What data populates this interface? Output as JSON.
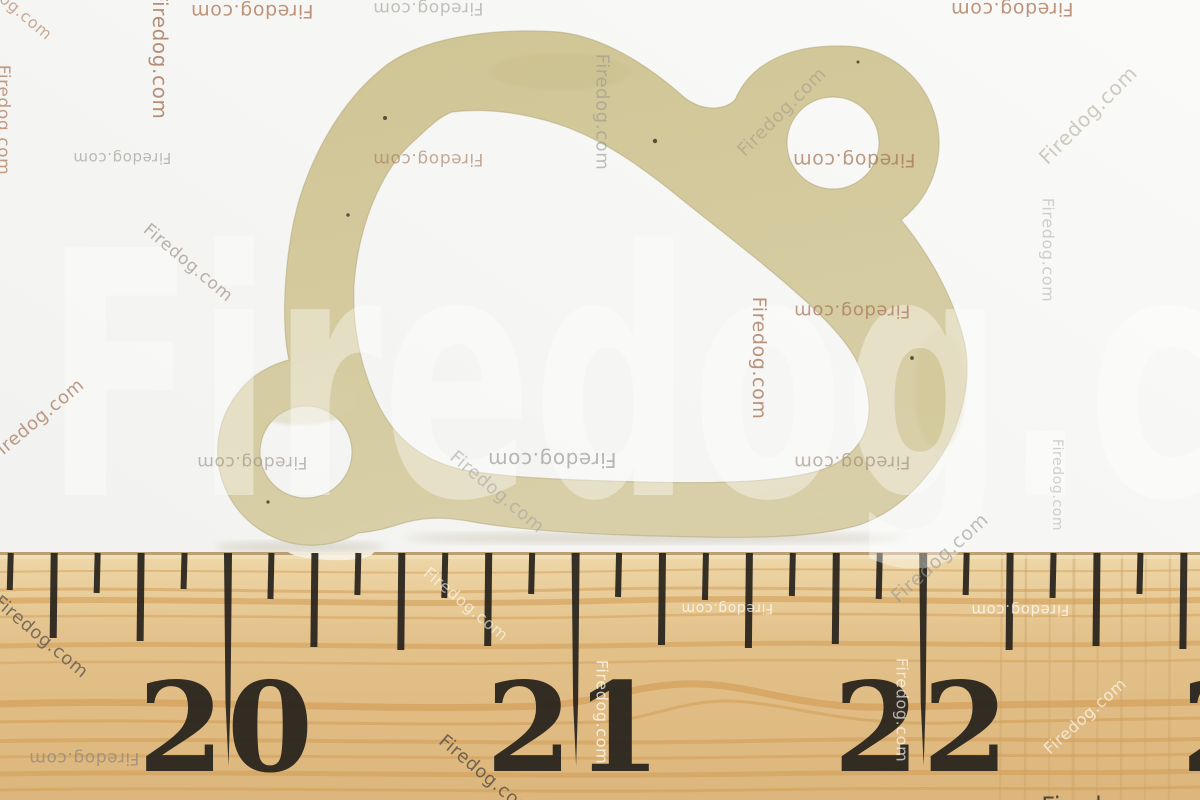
{
  "photo": {
    "watermark_text": "Firedog.com",
    "colors": {
      "background_top": "#fafaf8",
      "background_bottom": "#f0f0ee",
      "gasket": "#cfc493",
      "gasket_light": "#d8cfa8",
      "gasket_dark": "#c3b77f",
      "gasket_edge": "#a99d6e",
      "gasket_speck": "#55503a",
      "shadow": "#aca183",
      "wood_top": "#eed7a8",
      "wood_mid": "#e3c18a",
      "wood_bottom": "#dcb67c",
      "wood_grain": "#d09a52",
      "wood_streak": "#c9a266",
      "wood_edge_dark": "#8a6a42",
      "wood_edge_light": "#f2e2bd",
      "tick": "#26221c",
      "big_watermark": "rgba(255,255,255,0.38)"
    },
    "ruler": {
      "top_y": 552,
      "eighth_step": 43.45,
      "tick_lengths": {
        "eighth": 45,
        "quarter": 95,
        "inch": 214
      },
      "digit_baseline_y": 771,
      "inch_labels": [
        {
          "label": "20",
          "tick_x": 228,
          "left_digit": "2",
          "right_digit": "0"
        },
        {
          "label": "21",
          "tick_x": 576,
          "left_digit": "2",
          "right_digit": "1"
        },
        {
          "label": "22",
          "tick_x": 923.5,
          "left_digit": "2",
          "right_digit": "2"
        },
        {
          "label": "23",
          "tick_x": 1271,
          "left_digit": "2",
          "right_digit": "3"
        }
      ]
    },
    "watermarks": [
      {
        "x": 10,
        "y": 3,
        "rot": 40,
        "size": 16,
        "color": "rgba(170,120,90,0.6)"
      },
      {
        "x": 160,
        "y": 55,
        "rot": 90,
        "size": 20,
        "color": "rgba(166,118,88,0.8)"
      },
      {
        "x": 252,
        "y": 11,
        "rot": 180,
        "size": 19,
        "color": "rgba(170,115,82,0.75)"
      },
      {
        "x": 3,
        "y": 120,
        "rot": 90,
        "size": 17,
        "color": "rgba(170,115,82,0.7)"
      },
      {
        "x": 122,
        "y": 158,
        "rot": 180,
        "size": 15,
        "color": "rgba(150,145,140,0.6)"
      },
      {
        "x": 188,
        "y": 263,
        "rot": 40,
        "size": 17,
        "color": "rgba(145,128,118,0.6)"
      },
      {
        "x": 428,
        "y": 8,
        "rot": 180,
        "size": 17,
        "color": "rgba(150,145,140,0.55)"
      },
      {
        "x": 602,
        "y": 112,
        "rot": 90,
        "size": 18,
        "color": "rgba(150,150,148,0.6)"
      },
      {
        "x": 782,
        "y": 112,
        "rot": -45,
        "size": 18,
        "color": "rgba(168,162,138,0.65)"
      },
      {
        "x": 1012,
        "y": 9,
        "rot": 180,
        "size": 19,
        "color": "rgba(168,112,80,0.75)"
      },
      {
        "x": 1088,
        "y": 115,
        "rot": -45,
        "size": 20,
        "color": "rgba(176,170,152,0.6)"
      },
      {
        "x": 1048,
        "y": 250,
        "rot": 90,
        "size": 16,
        "color": "rgba(172,172,170,0.55)"
      },
      {
        "x": 428,
        "y": 159,
        "rot": 180,
        "size": 17,
        "color": "rgba(162,118,88,0.6)"
      },
      {
        "x": 854,
        "y": 160,
        "rot": 180,
        "size": 19,
        "color": "rgba(162,112,82,0.7)"
      },
      {
        "x": 37,
        "y": 420,
        "rot": -40,
        "size": 18,
        "color": "rgba(162,112,82,0.7)"
      },
      {
        "x": 252,
        "y": 462,
        "rot": 180,
        "size": 17,
        "color": "rgba(150,140,130,0.6)"
      },
      {
        "x": 552,
        "y": 460,
        "rot": 180,
        "size": 20,
        "color": "rgba(146,146,146,0.65)"
      },
      {
        "x": 497,
        "y": 492,
        "rot": 40,
        "size": 18,
        "color": "rgba(160,160,158,0.55)"
      },
      {
        "x": 759,
        "y": 358,
        "rot": 90,
        "size": 19,
        "color": "rgba(164,112,84,0.75)"
      },
      {
        "x": 852,
        "y": 311,
        "rot": 180,
        "size": 18,
        "color": "rgba(164,114,84,0.7)"
      },
      {
        "x": 852,
        "y": 462,
        "rot": 180,
        "size": 18,
        "color": "rgba(152,132,114,0.6)"
      },
      {
        "x": 1057,
        "y": 485,
        "rot": 90,
        "size": 14,
        "color": "rgba(172,172,170,0.55)"
      },
      {
        "x": 940,
        "y": 558,
        "rot": -42,
        "size": 19,
        "color": "rgba(150,150,148,0.6)"
      },
      {
        "x": 41,
        "y": 637,
        "rot": 40,
        "size": 18,
        "color": "rgba(96,88,80,0.8)"
      },
      {
        "x": 84,
        "y": 758,
        "rot": 180,
        "size": 17,
        "color": "rgba(132,130,126,0.65)"
      },
      {
        "x": 486,
        "y": 776,
        "rot": 40,
        "size": 18,
        "color": "rgba(88,78,66,0.8)"
      },
      {
        "x": 466,
        "y": 604,
        "rot": 40,
        "size": 16,
        "color": "rgba(255,255,255,0.6)"
      },
      {
        "x": 602,
        "y": 712,
        "rot": 90,
        "size": 16,
        "color": "rgba(255,255,255,0.75)"
      },
      {
        "x": 727,
        "y": 608,
        "rot": 180,
        "size": 14,
        "color": "rgba(255,255,255,0.7)"
      },
      {
        "x": 1020,
        "y": 610,
        "rot": 180,
        "size": 15,
        "color": "rgba(255,255,255,0.7)"
      },
      {
        "x": 902,
        "y": 710,
        "rot": 90,
        "size": 16,
        "color": "rgba(255,255,255,0.65)"
      },
      {
        "x": 1085,
        "y": 716,
        "rot": -42,
        "size": 16,
        "color": "rgba(255,255,255,0.65)"
      },
      {
        "x": 1118,
        "y": 806,
        "rot": 0,
        "size": 24,
        "color": "rgba(70,58,45,0.9)"
      }
    ]
  }
}
